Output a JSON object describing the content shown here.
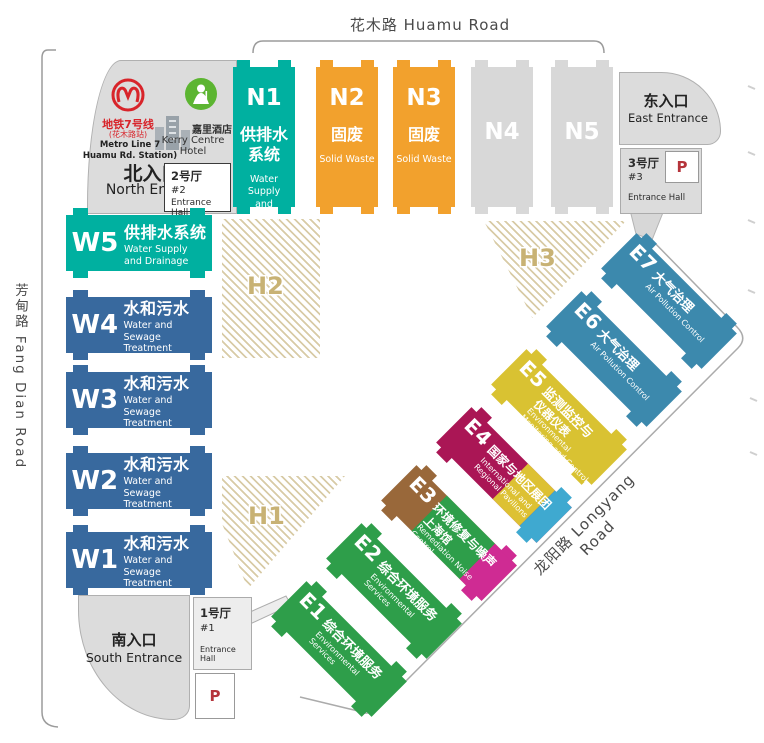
{
  "roads": {
    "top": "花木路 Huamu Road",
    "left": "芳甸路 Fang Dian Road",
    "right": "龙阳路 Longyang Road"
  },
  "north_entrance": {
    "zh": "北入口",
    "en": "North Entrance",
    "metro_line": "地铁7号线",
    "metro_station": "(花木路站)",
    "metro_line_en": "Metro Line 7",
    "metro_station_en": "Huamu Rd. Station)",
    "hotel_zh": "嘉里酒店",
    "hotel_en": "Kerry Centre Hotel"
  },
  "east_entrance": {
    "zh": "东入口",
    "en": "East Entrance"
  },
  "south_entrance": {
    "zh": "南入口",
    "en": "South Entrance"
  },
  "entrance_halls": {
    "hall1": {
      "zh": "1号厅",
      "num": "#1",
      "en": "Entrance Hall"
    },
    "hall2": {
      "zh": "2号厅",
      "num": "#2",
      "en": "Entrance Hall"
    },
    "hall3": {
      "zh": "3号厅",
      "num": "#3",
      "en": "Entrance Hall"
    }
  },
  "parking_label": "P",
  "hatch_labels": {
    "h1": "H1",
    "h2": "H2",
    "h3": "H3"
  },
  "n_halls": [
    {
      "id": "N1",
      "zh": "供排水\n系统",
      "en": "Water Supply\nand Drainage",
      "color": "#00b0a0"
    },
    {
      "id": "N2",
      "zh": "固废",
      "en": "Solid Waste",
      "color": "#f2a12d"
    },
    {
      "id": "N3",
      "zh": "固废",
      "en": "Solid Waste",
      "color": "#f2a12d"
    },
    {
      "id": "N4",
      "zh": "",
      "en": "",
      "color": "#d8d8d8"
    },
    {
      "id": "N5",
      "zh": "",
      "en": "",
      "color": "#d8d8d8"
    }
  ],
  "w_halls": [
    {
      "id": "W5",
      "zh": "供排水系统",
      "en": "Water Supply\nand Drainage",
      "color": "#00b0a0"
    },
    {
      "id": "W4",
      "zh": "水和污水",
      "en": "Water and Sewage\nTreatment",
      "color": "#38699e"
    },
    {
      "id": "W3",
      "zh": "水和污水",
      "en": "Water and Sewage\nTreatment",
      "color": "#38699e"
    },
    {
      "id": "W2",
      "zh": "水和污水",
      "en": "Water and Sewage\nTreatment",
      "color": "#38699e"
    },
    {
      "id": "W1",
      "zh": "水和污水",
      "en": "Water and Sewage\nTreatment",
      "color": "#38699e"
    }
  ],
  "e_halls": [
    {
      "id": "E1",
      "zh": "综合环境服务",
      "en": "Environmental\nServices",
      "c1": "#2e9e4a",
      "c3": "#2e9e4a"
    },
    {
      "id": "E2",
      "zh": "综合环境服务",
      "en": "Environmental\nServices",
      "c1": "#2e9e4a",
      "c3": "#2e9e4a"
    },
    {
      "id": "E3",
      "zh": "环境修复与噪声",
      "zh2": "上海馆",
      "en": "Remediation Noise Control\nShanghai Pavilion",
      "c1": "#99683a",
      "c2": "#2e9e4a",
      "c3": "#cf2b93"
    },
    {
      "id": "E4",
      "zh": "国家与地区展团",
      "en": "International and\nRegional Pavilions",
      "c1": "#aa1655",
      "c2": "#ddc133",
      "c3": "#3fa9d0"
    },
    {
      "id": "E5",
      "zh": "监测监控与",
      "zh2": "仪器仪表",
      "en": "Environmental\nMonitoring and Control",
      "c1": "#d9c232",
      "c3": "#d9c232"
    },
    {
      "id": "E6",
      "zh": "大气治理",
      "en": "Air Pollution Control",
      "c1": "#3c89ad",
      "c3": "#3c89ad"
    },
    {
      "id": "E7",
      "zh": "大气治理",
      "en": "Air Pollution Control",
      "c1": "#3c89ad",
      "c3": "#3c89ad"
    }
  ],
  "colors": {
    "hatch_beige": "#d8cba6",
    "hall_gray": "#d8d8d8",
    "metro_red": "#d8242a",
    "hotel_green": "#5cb531",
    "parking_red": "#b5343b"
  }
}
